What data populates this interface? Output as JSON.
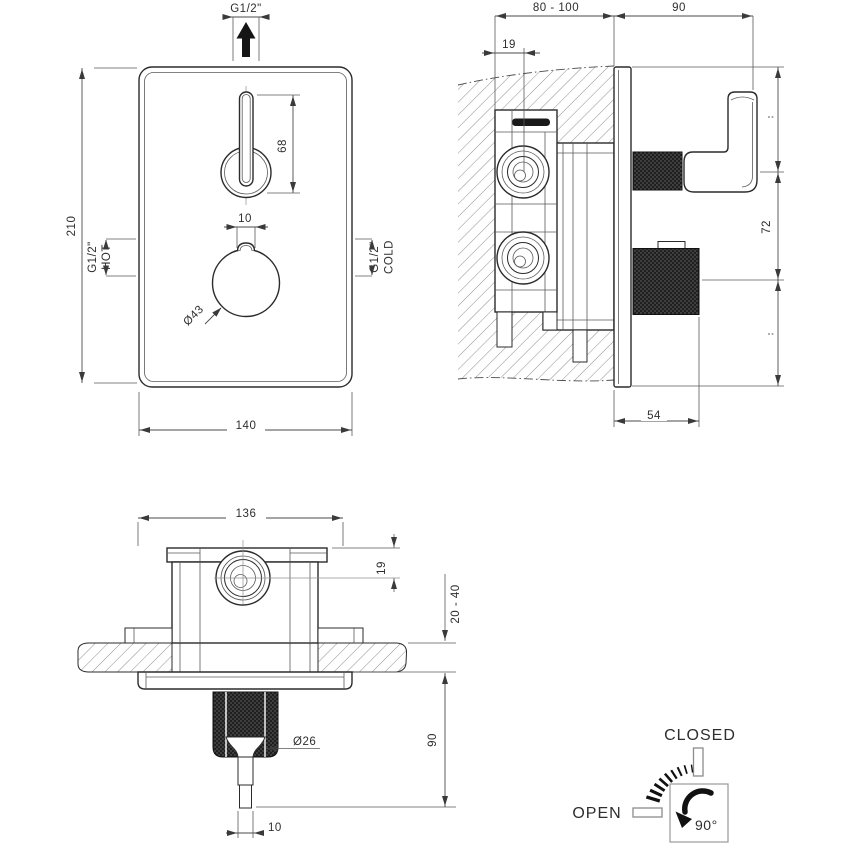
{
  "drawing": {
    "title": "thermostatic-mixer-technical-drawing",
    "front_view": {
      "inlet_top_size": "G1/2\"",
      "overall_height": "210",
      "overall_width": "140",
      "lever_length": "68",
      "tab_width": "10",
      "knob_diameter": "Ø43",
      "hot_size": "G1/2\"",
      "hot_label": "HOT",
      "cold_size": "G1/2\"",
      "cold_label": "COLD"
    },
    "side_view": {
      "recess_depth_range": "80 - 100",
      "handle_projection": "90",
      "port_offset": "19",
      "axis_distance": "72",
      "knob_projection": "54"
    },
    "bottom_view": {
      "body_width": "136",
      "port_offset": "19",
      "wall_thickness_range": "20 - 40",
      "lever_projection": "90",
      "lever_width": "10",
      "knob_diameter": "Ø26"
    },
    "rotation_legend": {
      "closed": "CLOSED",
      "open": "OPEN",
      "angle": "90°"
    }
  }
}
